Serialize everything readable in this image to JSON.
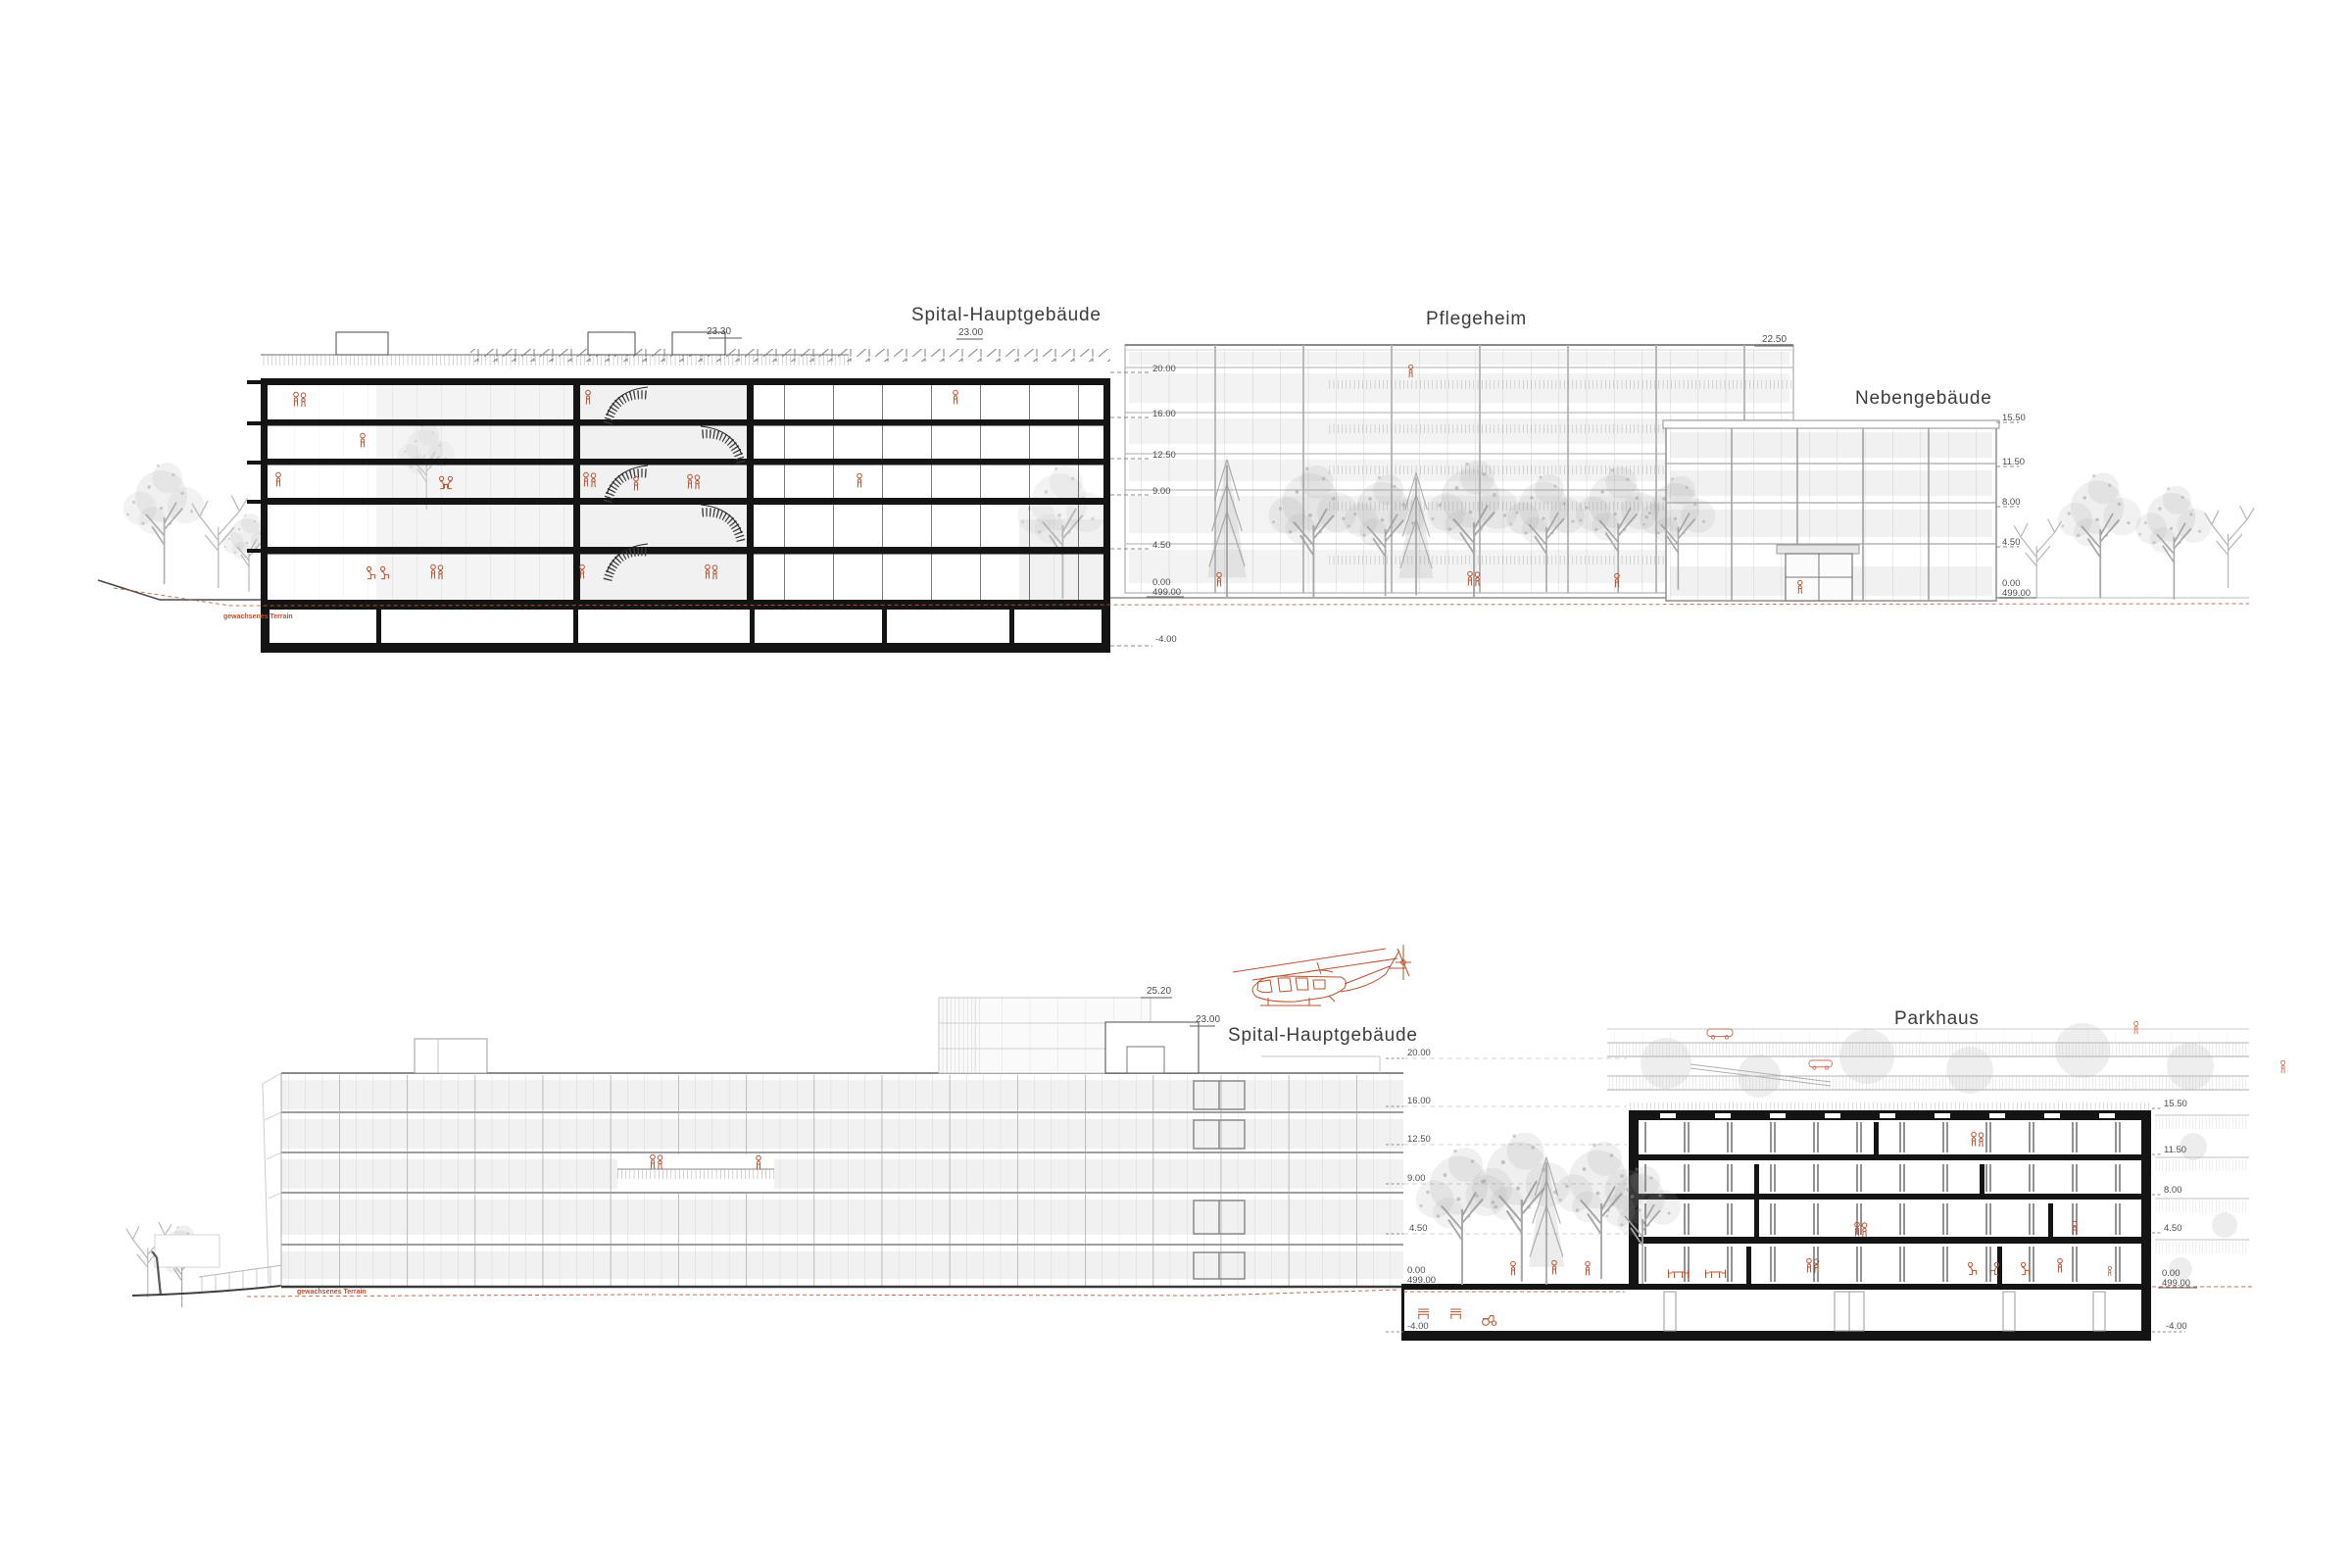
{
  "colors": {
    "accent_red": "#b9502f",
    "section_ink": "#141414",
    "facade_gray": "#c6c6c6",
    "title_gray": "#3c3c3c",
    "level_gray": "#4d4d4d"
  },
  "top_drawing": {
    "spital": {
      "title": "Spital-Hauptgebäude",
      "dim_left": "23.30",
      "dim_right": "23.00",
      "terrain_label": "gewachsenes Terrain"
    },
    "pflegeheim": {
      "title": "Pflegeheim",
      "dim_roof": "22.50",
      "levels": [
        "20.00",
        "16.00",
        "12.50",
        "9.00",
        "4.50"
      ],
      "level_zero": "0.00",
      "level_zero_abs": "499.00"
    },
    "nebengebaeude": {
      "title": "Nebengebäude",
      "levels": [
        "15.50",
        "11.50",
        "8.00",
        "4.50"
      ],
      "level_zero": "0.00",
      "level_zero_abs": "499.00"
    },
    "level_minus4": "-4.00"
  },
  "bottom_drawing": {
    "spital": {
      "title": "Spital-Hauptgebäude",
      "dim_roof_upper": "25.20",
      "dim_roof": "23.00",
      "terrain_label": "gewachsenes Terrain"
    },
    "mid": {
      "levels": [
        "20.00",
        "16.00",
        "12.50",
        "9.00",
        "4.50"
      ],
      "level_zero": "0.00",
      "level_zero_abs": "499.00",
      "level_minus4": "-4.00"
    },
    "parkhaus": {
      "title": "Parkhaus",
      "levels": [
        "15.50",
        "11.50",
        "8.00",
        "4.50"
      ],
      "level_zero": "0.00",
      "level_zero_abs": "499.00",
      "level_minus4": "-4.00"
    }
  }
}
